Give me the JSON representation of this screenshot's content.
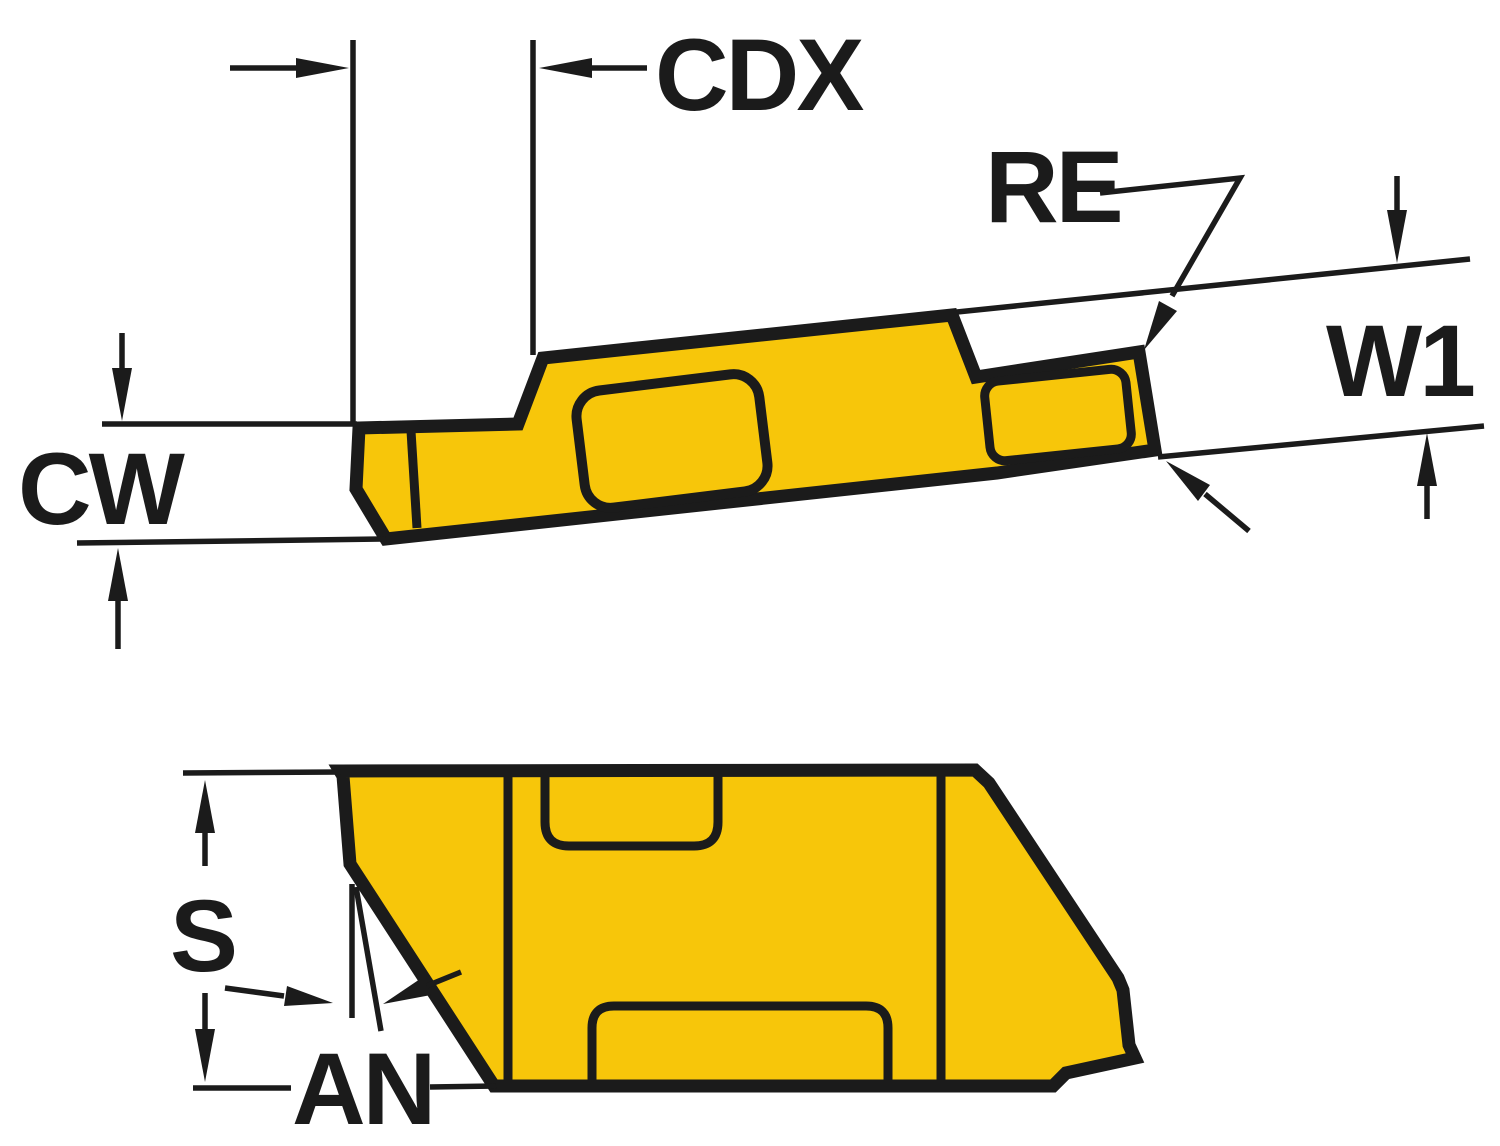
{
  "figure": {
    "title": "Grooving insert dimension drawing",
    "labels": {
      "cdx": "CDX",
      "re": "RE",
      "w1": "W1",
      "cw": "CW",
      "s": "S",
      "an": "AN"
    },
    "colors": {
      "insert_fill": "#F7C60A",
      "line": "#1B1B1B",
      "background": "#FFFFFF"
    }
  }
}
